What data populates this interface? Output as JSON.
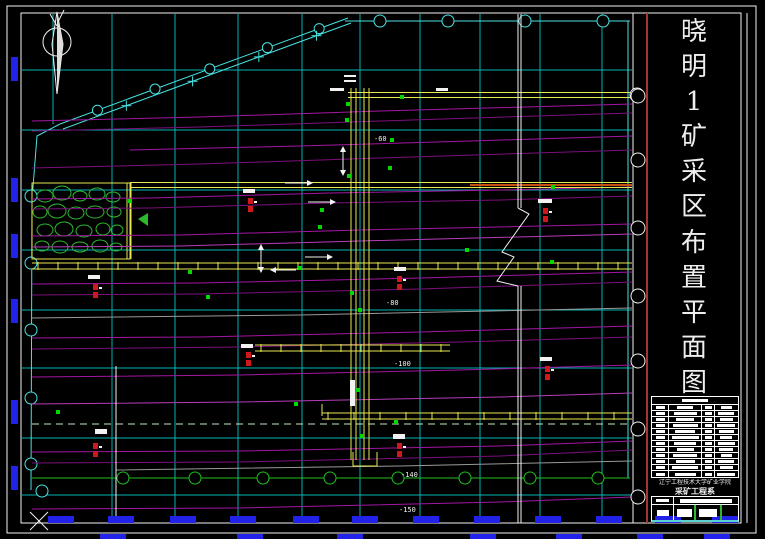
{
  "sheet": {
    "title": "晓明1矿采区布置平面图",
    "type": "mine-district-layout-plan"
  },
  "title_strip": {
    "chars": [
      "晓",
      "明",
      "1",
      "矿",
      "采",
      "区",
      "布",
      "置",
      "平",
      "面",
      "图"
    ]
  },
  "title_block": {
    "school": "辽宁工程技术大学矿业学院",
    "department": "采矿工程系",
    "legend_rows": 12
  },
  "colors": {
    "background": "#000000",
    "border_white": "#f2f2f2",
    "divider_red": "#a23535",
    "grid_cyan": "#00b4b4",
    "boundary_cyan": "#4ae2e2",
    "contour_magenta": "#a316a3",
    "roadway_yellow": "#e8e852",
    "seam_orange": "#c85010",
    "goaf_green": "#2db82d",
    "marker_red": "#d01818",
    "dot_green": "#00d800",
    "coord_blue": "#2222e8",
    "dashed_green": "#c2e8c2",
    "boundary_green": "#20c020"
  },
  "elevation_labels": [
    {
      "text": "-60",
      "x": 374,
      "y": 141
    },
    {
      "text": "-80",
      "x": 386,
      "y": 305
    },
    {
      "text": "-100",
      "x": 394,
      "y": 366
    },
    {
      "text": "-140",
      "x": 401,
      "y": 477
    },
    {
      "text": "-150",
      "x": 399,
      "y": 512
    }
  ],
  "drawing": {
    "grid_vx": [
      53,
      112,
      175,
      238,
      302,
      360,
      420,
      480,
      540,
      602
    ],
    "grid_hy": [
      70,
      130,
      190,
      250,
      310,
      368,
      438,
      495
    ],
    "top_boundary": {
      "y": 21,
      "x1": 345,
      "x2": 630,
      "circles": [
        380,
        448,
        525,
        603
      ]
    },
    "right_boundary": {
      "x": 628,
      "y1": 21,
      "y2": 478
    },
    "right_circles": {
      "x": 638,
      "r": 7,
      "ys": [
        96,
        160,
        228,
        296,
        361,
        429,
        497
      ]
    },
    "left_boundary": {
      "pts": "60,124 37,136 32,200 31,490",
      "circle_x": 31,
      "circles": [
        196,
        263,
        330,
        398,
        464
      ]
    },
    "extra_circle": {
      "x": 42,
      "y": 491
    },
    "green_boundary": {
      "y": 478,
      "x1": 32,
      "x2": 630,
      "circles": [
        123,
        195,
        263,
        330,
        398,
        465,
        530,
        598
      ]
    },
    "diagonal": {
      "x1": 60,
      "y1": 124,
      "x2": 348,
      "y2": 18,
      "off": 5,
      "circle_t": [
        0.13,
        0.33,
        0.52,
        0.72,
        0.9
      ],
      "plus_t": [
        0.22,
        0.45,
        0.68,
        0.88
      ]
    },
    "contours": [
      {
        "d": "M32,121 L200,117 L380,111 L632,104",
        "c": "#a316a3"
      },
      {
        "d": "M32,131 L200,127 L380,121 L632,113",
        "c": "#7c107c"
      },
      {
        "d": "M130,150 L300,146 L470,141 L632,136",
        "c": "#a316a3"
      },
      {
        "d": "M32,168 L200,164 L380,158 L632,150",
        "c": "#7c107c"
      },
      {
        "d": "M32,199 L150,198 L330,193 L500,190 L632,187",
        "c": "#a316a3"
      },
      {
        "d": "M32,209 L150,208 L330,203 L500,200 L632,196",
        "c": "#7c107c"
      },
      {
        "d": "M32,236 L180,235 L360,230 L632,224",
        "c": "#a316a3"
      },
      {
        "d": "M32,247 L180,246 L360,241 L632,234",
        "c": "#b83cb8"
      },
      {
        "d": "M32,284 L200,283 L420,278 L632,272",
        "c": "#a316a3"
      },
      {
        "d": "M32,295 L200,294 L420,289 L632,282",
        "c": "#7c107c"
      },
      {
        "d": "M32,318 L300,315 L632,308",
        "c": "#9a9a9a"
      },
      {
        "d": "M32,338 L200,337 L420,332 L632,326",
        "c": "#a316a3"
      },
      {
        "d": "M32,349 L240,347 L460,342 L632,337",
        "c": "#7c107c"
      },
      {
        "d": "M32,377 L240,375 L460,370 L632,365",
        "c": "#a316a3"
      },
      {
        "d": "M32,404 L240,402 L500,397 L632,393",
        "c": "#b83cb8"
      },
      {
        "d": "M32,452 L240,451 L500,446 L632,441",
        "c": "#a316a3"
      },
      {
        "d": "M32,463 L240,462 L500,456 L632,450",
        "c": "#7c107c"
      },
      {
        "d": "M116,470 L400,466 L632,461",
        "c": "#9a9a9a"
      },
      {
        "d": "M32,509 L240,508 L500,502 L632,497",
        "c": "#a316a3"
      }
    ],
    "roadways_h": [
      {
        "y": 95,
        "x1": 348,
        "x2": 630,
        "gap": 5,
        "tick": 0,
        "end_circle": true
      },
      {
        "y": 185,
        "x1": 130,
        "x2": 632,
        "gap": 5,
        "tick": 0
      },
      {
        "y": 266,
        "x1": 32,
        "x2": 632,
        "gap": 6,
        "tick": 20
      },
      {
        "y": 348,
        "x1": 255,
        "x2": 450,
        "gap": 6,
        "tick": 20
      },
      {
        "y": 416,
        "x1": 322,
        "x2": 632,
        "gap": 6,
        "tick": 26
      }
    ],
    "seam_overlay": {
      "y": 185,
      "x1": 470,
      "x2": 632
    },
    "dashed_line": {
      "y": 424,
      "x1": 32,
      "x2": 630
    },
    "vroad": {
      "xs": [
        351,
        356,
        364,
        369
      ],
      "y1": 88,
      "y2": 460,
      "hook": "M353,452 L353,466 L377,466 L377,452",
      "stub": "M322,416 L322,404"
    },
    "section_line": {
      "x": 518,
      "top": [
        14,
        208
      ],
      "bot": [
        286,
        523
      ],
      "zig": "M518,208 L529,214 L502,252 L514,257 L497,281 L518,286"
    },
    "white_vline": {
      "x": 116,
      "y1": 366,
      "y2": 523
    },
    "goaf": {
      "x": 32,
      "y": 183,
      "w": 98,
      "h": 76,
      "edge2": [
        127,
        131
      ],
      "blobs": [
        [
          45,
          196,
          8,
          6
        ],
        [
          62,
          193,
          9,
          7
        ],
        [
          80,
          196,
          7,
          5
        ],
        [
          97,
          194,
          8,
          6
        ],
        [
          113,
          197,
          7,
          5
        ],
        [
          40,
          212,
          7,
          6
        ],
        [
          57,
          211,
          9,
          7
        ],
        [
          76,
          213,
          8,
          6
        ],
        [
          95,
          212,
          9,
          6
        ],
        [
          114,
          212,
          7,
          5
        ],
        [
          45,
          230,
          8,
          6
        ],
        [
          64,
          229,
          9,
          7
        ],
        [
          84,
          231,
          8,
          6
        ],
        [
          103,
          229,
          7,
          6
        ],
        [
          117,
          230,
          6,
          5
        ],
        [
          42,
          246,
          7,
          5
        ],
        [
          60,
          247,
          8,
          6
        ],
        [
          80,
          247,
          8,
          5
        ],
        [
          100,
          246,
          8,
          6
        ],
        [
          116,
          247,
          6,
          4
        ]
      ],
      "arrow": "138,219 148,213 148,226"
    },
    "red_markers": [
      [
        250,
        198
      ],
      [
        399,
        276
      ],
      [
        399,
        443
      ],
      [
        95,
        443
      ],
      [
        95,
        284
      ],
      [
        547,
        366
      ],
      [
        545,
        208
      ],
      [
        248,
        352
      ]
    ],
    "green_dots": [
      [
        402,
        97
      ],
      [
        348,
        104
      ],
      [
        347,
        120
      ],
      [
        349,
        176
      ],
      [
        392,
        140
      ],
      [
        390,
        168
      ],
      [
        322,
        210
      ],
      [
        320,
        227
      ],
      [
        300,
        268
      ],
      [
        190,
        272
      ],
      [
        553,
        187
      ],
      [
        352,
        293
      ],
      [
        360,
        310
      ],
      [
        358,
        390
      ],
      [
        396,
        422
      ],
      [
        362,
        436
      ],
      [
        296,
        404
      ],
      [
        467,
        250
      ],
      [
        552,
        262
      ],
      [
        130,
        201
      ],
      [
        208,
        297
      ],
      [
        58,
        412
      ]
    ],
    "white_blobs": [
      [
        243,
        189,
        12,
        4
      ],
      [
        394,
        267,
        12,
        4
      ],
      [
        538,
        199,
        14,
        4
      ],
      [
        241,
        344,
        12,
        4
      ],
      [
        95,
        429,
        12,
        5
      ],
      [
        393,
        434,
        12,
        5
      ],
      [
        540,
        357,
        12,
        4
      ],
      [
        88,
        275,
        12,
        4
      ],
      [
        350,
        380,
        5,
        26
      ],
      [
        330,
        88,
        14,
        3
      ],
      [
        436,
        88,
        12,
        3
      ]
    ],
    "arrows": [
      {
        "x": 285,
        "y": 183,
        "len": 22,
        "dir": "r"
      },
      {
        "x": 308,
        "y": 202,
        "len": 22,
        "dir": "r"
      },
      {
        "x": 305,
        "y": 257,
        "len": 22,
        "dir": "r"
      },
      {
        "x": 296,
        "y": 270,
        "len": 20,
        "dir": "l"
      },
      {
        "x": 343,
        "y": 147,
        "len": 28,
        "dir": "v"
      },
      {
        "x": 261,
        "y": 245,
        "len": 27,
        "dir": "v"
      }
    ],
    "blue_left": {
      "x": 11,
      "w": 7,
      "h": 24,
      "ys": [
        57,
        178,
        234,
        299,
        400,
        466
      ]
    },
    "blue_bottom": {
      "y": 516,
      "w": 26,
      "h": 7,
      "xs": [
        48,
        108,
        170,
        230,
        293,
        352,
        413,
        474,
        535,
        596,
        655,
        712
      ]
    },
    "blue_bottom2": {
      "y": 534,
      "w": 26,
      "h": 5,
      "xs": [
        100,
        237,
        337,
        470,
        556,
        637,
        704
      ]
    },
    "equals_mark": {
      "x": 344,
      "y": 76
    }
  }
}
